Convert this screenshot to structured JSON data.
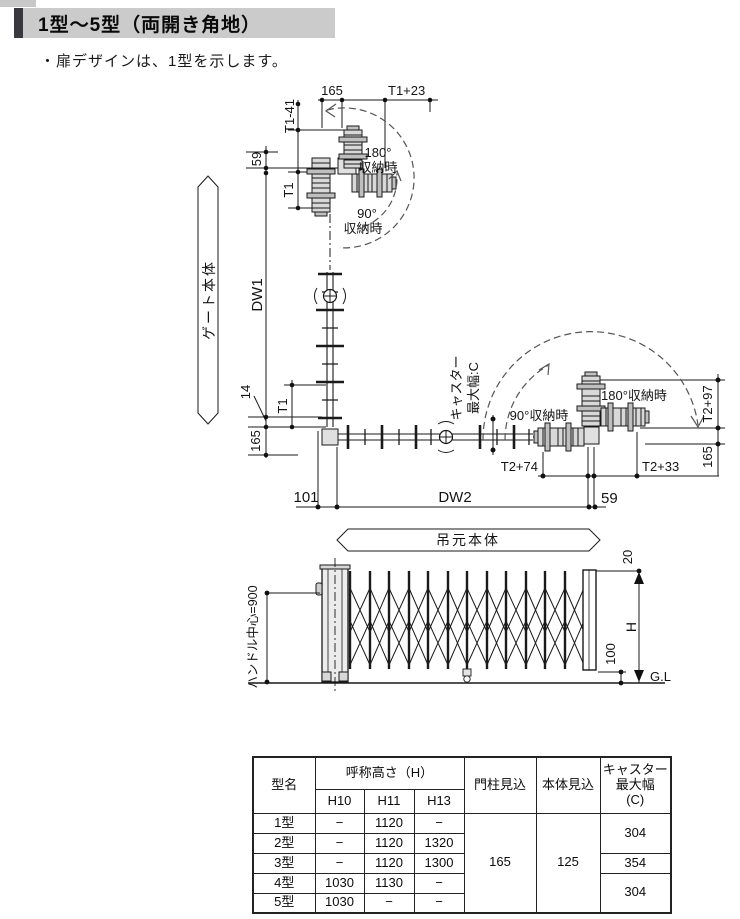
{
  "page": {
    "title": "1型～5型（両開き角地）",
    "note": "・扉デザインは、1型を示します。"
  },
  "colors": {
    "header_bg": "#cbcbcb",
    "header_accent": "#38383e",
    "line": "#1a1a1a",
    "accordion_fill": "#d8d8d8"
  },
  "plan": {
    "banner_gate": "ゲート本体",
    "banner_hinge": "吊元本体",
    "store180_top_deg": "180°",
    "store180_top_txt": "収納時",
    "store90_top_deg": "90°",
    "store90_top_txt": "収納時",
    "store90_right": "90°収納時",
    "store180_right": "180°収納時",
    "caster_label_1": "キャスター",
    "caster_label_2": "最大幅:C",
    "dims": {
      "d165_top": "165",
      "t1_plus23": "T1+23",
      "t1_minus41": "T1-41",
      "d59_left": "59",
      "t1_upper": "T1",
      "dw1": "DW1",
      "d14": "14",
      "t1_lower": "T1",
      "d165_left": "165",
      "d101": "101",
      "dw2": "DW2",
      "d59_bottom": "59",
      "t2_plus74": "T2+74",
      "t2_plus33": "T2+33",
      "t2_plus97": "T2+97",
      "d165_right": "165"
    }
  },
  "elevation": {
    "handle_center": "ハンドル中心=900",
    "d20": "20",
    "height": "H",
    "d100": "100",
    "ground": "G.L"
  },
  "table": {
    "col_model": "型名",
    "col_nominal_height": "呼称高さ（H）",
    "col_h10": "H10",
    "col_h11": "H11",
    "col_h13": "H13",
    "col_post_depth": "門柱見込",
    "col_body_depth": "本体見込",
    "col_caster": "キャスター\n最大幅\n(C)",
    "post_depth": "165",
    "body_depth": "125",
    "rows": [
      {
        "model": "1型",
        "h10": "−",
        "h11": "1120",
        "h13": "−"
      },
      {
        "model": "2型",
        "h10": "−",
        "h11": "1120",
        "h13": "1320"
      },
      {
        "model": "3型",
        "h10": "−",
        "h11": "1120",
        "h13": "1300"
      },
      {
        "model": "4型",
        "h10": "1030",
        "h11": "1130",
        "h13": "−"
      },
      {
        "model": "5型",
        "h10": "1030",
        "h11": "−",
        "h13": "−"
      }
    ],
    "caster_12": "304",
    "caster_3": "354",
    "caster_45": "304"
  }
}
